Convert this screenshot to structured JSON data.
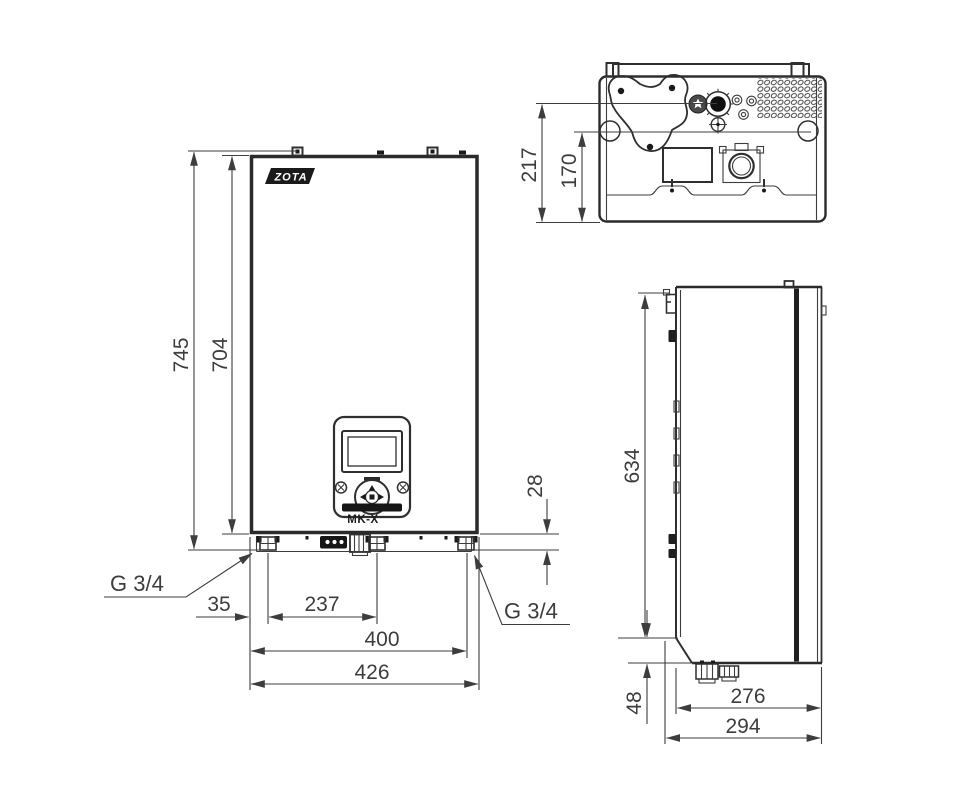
{
  "drawing": {
    "background_color": "#ffffff",
    "line_color": "#3d3d3d",
    "views": {
      "front": {
        "logo": "ZOTA",
        "model_label": "MK-X",
        "connections": {
          "left_thread": "G 3/4",
          "right_thread": "G 3/4"
        },
        "dimensions": {
          "overall_height": "745",
          "body_height": "704",
          "connection_protrusion": "28",
          "edge_to_left_connection": "35",
          "left_to_center_connection": "237",
          "edge_to_right_connection": "400",
          "overall_width": "426"
        }
      },
      "top": {
        "dimensions": {
          "depth_to_connections": "217",
          "depth_to_fasteners": "170"
        }
      },
      "side": {
        "dimensions": {
          "height_to_bracket_notch": "634",
          "bottom_section_height": "48",
          "body_depth": "276",
          "overall_depth": "294"
        }
      }
    }
  }
}
